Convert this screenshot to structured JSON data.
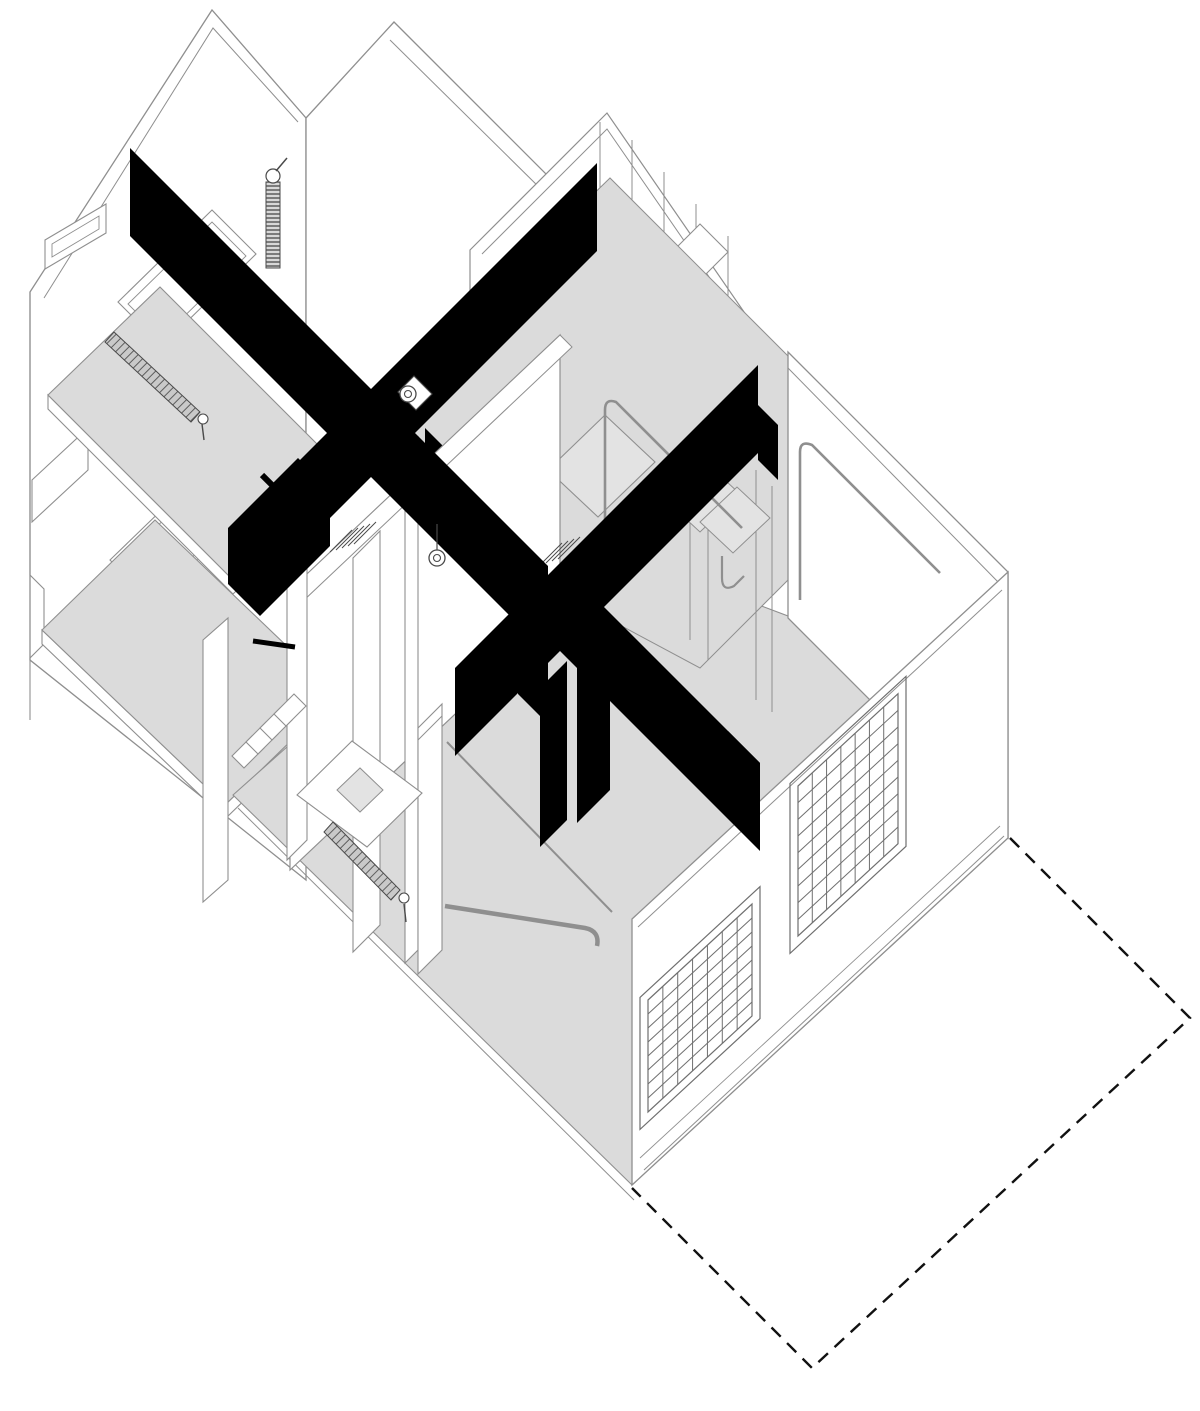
{
  "meta": {
    "title": "Axonometric cutaway drawing of an apartment with X cross-bracing beams",
    "drawing_type": "plan-oblique (military) axonometric, 45 degrees",
    "canvas_w": 1200,
    "canvas_h": 1411,
    "background": "#ffffff"
  },
  "palette": {
    "white": "#ffffff",
    "floor_gray": "#dbdbdb",
    "panel_gray": "#e3e3e3",
    "beam_black": "#000000",
    "line": "#8f8f8f",
    "line_dark": "#4a4a4a",
    "grid_line": "#6f6f6f",
    "dash_color": "#111111"
  },
  "dashed_outline": {
    "name": "projected-footprint-dashed-outline",
    "d": "M 1010 838 L 1190 1018 L 812 1368 L 632 1188",
    "dash": "13 9",
    "sw": 2.4
  },
  "windows": [
    {
      "name": "gridded-window-front-left",
      "x0": 648,
      "y0": 1000,
      "len": 104,
      "slope": -0.923,
      "h": 112,
      "nv": 7,
      "nh": 8
    },
    {
      "name": "gridded-window-front-right",
      "x0": 798,
      "y0": 786,
      "len": 100,
      "slope": -0.923,
      "h": 150,
      "nv": 7,
      "nh": 9
    }
  ],
  "shapes": [
    {
      "name": "wall-back-left",
      "type": "polygon",
      "points": "30,292 212,10 306,118 306,880 30,660",
      "fill": "white",
      "stroke": "line",
      "sw": 1.3
    },
    {
      "name": "wall-back-left-thickness-edge",
      "type": "polyline",
      "points": "44,298 213,28 298,122",
      "fill": "none",
      "stroke": "line",
      "sw": 1
    },
    {
      "name": "wall-back-right",
      "type": "polygon",
      "points": "306,118 394,22 866,494 866,850 306,850",
      "fill": "white",
      "stroke": "line",
      "sw": 1.3
    },
    {
      "name": "wall-back-right-thickness-edge",
      "type": "line",
      "x1": 390,
      "y1": 40,
      "x2": 858,
      "y2": 502,
      "stroke": "line",
      "sw": 1
    },
    {
      "name": "left-wall-window-slit-top",
      "type": "polygon",
      "points": "45,240 106,204 106,233 45,269",
      "fill": "white",
      "stroke": "line",
      "sw": 1.1
    },
    {
      "name": "left-wall-window-slit-top-inner",
      "type": "polygon",
      "points": "52,244 99,216 99,229 52,257",
      "fill": "none",
      "stroke": "line",
      "sw": 0.9
    },
    {
      "name": "left-wall-window-mid",
      "type": "polygon",
      "points": "118,302 212,210 256,254 162,346",
      "fill": "white",
      "stroke": "line",
      "sw": 1.1
    },
    {
      "name": "left-wall-window-mid-inner",
      "type": "polygon",
      "points": "128,304 212,222 246,256 162,338",
      "fill": "none",
      "stroke": "line",
      "sw": 0.9
    },
    {
      "name": "left-wall-window-low",
      "type": "polygon",
      "points": "110,560 205,468 248,511 153,603",
      "fill": "white",
      "stroke": "line",
      "sw": 1.1
    },
    {
      "name": "left-wall-window-low-inner",
      "type": "polygon",
      "points": "120,562 205,480 238,513 153,595",
      "fill": "none",
      "stroke": "line",
      "sw": 0.9
    },
    {
      "name": "left-wall-window-small",
      "type": "polygon",
      "points": "32,480 88,428 88,470 32,522",
      "fill": "white",
      "stroke": "line",
      "sw": 1.1
    },
    {
      "name": "left-wall-profile-steps",
      "type": "path",
      "d": "M 30 292 V 575 l 14 14 v 55 l -14 14 V 720",
      "fill": "none",
      "stroke": "line",
      "sw": 1.1
    },
    {
      "name": "gable-wall-small",
      "type": "polygon",
      "points": "470,250 607,113 753,325 753,460 470,460",
      "fill": "white",
      "stroke": "line",
      "sw": 1.2
    },
    {
      "name": "gable-wall-small-thickness-edge",
      "type": "polyline",
      "points": "482,254 607,129 745,329",
      "fill": "none",
      "stroke": "line",
      "sw": 1
    },
    {
      "name": "wall-fin-1",
      "type": "line",
      "x1": 600,
      "y1": 122,
      "x2": 600,
      "y2": 460,
      "stroke": "line",
      "sw": 1
    },
    {
      "name": "wall-fin-2",
      "type": "line",
      "x1": 632,
      "y1": 140,
      "x2": 632,
      "y2": 460,
      "stroke": "line",
      "sw": 1
    },
    {
      "name": "wall-fin-3",
      "type": "line",
      "x1": 664,
      "y1": 172,
      "x2": 664,
      "y2": 460,
      "stroke": "line",
      "sw": 1
    },
    {
      "name": "wall-fin-4",
      "type": "line",
      "x1": 696,
      "y1": 204,
      "x2": 696,
      "y2": 460,
      "stroke": "line",
      "sw": 1
    },
    {
      "name": "wall-fin-5",
      "type": "line",
      "x1": 728,
      "y1": 236,
      "x2": 728,
      "y2": 460,
      "stroke": "line",
      "sw": 1
    },
    {
      "name": "beam-pocket-tab",
      "type": "polygon",
      "points": "672,252 700,224 728,252 700,280",
      "fill": "white",
      "stroke": "line",
      "sw": 1.1
    },
    {
      "name": "heating-pipe-coil",
      "type": "polygon",
      "points": "266,182 280,182 280,268 266,268",
      "fill": "coil",
      "stroke": "line_dark",
      "sw": 1
    },
    {
      "name": "heating-pipe-valve",
      "type": "circle",
      "cx": 273,
      "cy": 176,
      "r": 7,
      "fill": "white",
      "stroke": "line_dark",
      "sw": 1.2
    },
    {
      "name": "heating-pipe-stem",
      "type": "line",
      "x1": 276,
      "y1": 171,
      "x2": 287,
      "y2": 158,
      "stroke": "line_dark",
      "sw": 1.5
    },
    {
      "name": "floor-upper-slab-edge",
      "type": "polygon",
      "points": "48,395 233,580 345,472 345,486 233,594 48,409",
      "fill": "white",
      "stroke": "line",
      "sw": 1.1
    },
    {
      "name": "floor-upper",
      "type": "polygon",
      "points": "48,395 160,287 345,472 233,580",
      "fill": "floor_gray",
      "stroke": "line",
      "sw": 1.1
    },
    {
      "name": "radiator-upper",
      "type": "polygon",
      "points": "114,332 200,412 191,422 105,342",
      "fill": "hatch",
      "stroke": "line_dark",
      "sw": 1
    },
    {
      "name": "radiator-upper-cap",
      "type": "circle",
      "cx": 203,
      "cy": 419,
      "r": 5,
      "fill": "white",
      "stroke": "line_dark",
      "sw": 1.1
    },
    {
      "name": "radiator-upper-leg",
      "type": "line",
      "x1": 202,
      "y1": 424,
      "x2": 204,
      "y2": 440,
      "stroke": "line_dark",
      "sw": 1.4
    },
    {
      "name": "floor-mid-slab-edge",
      "type": "polygon",
      "points": "42,630 225,805 338,695 338,709 225,819 42,644",
      "fill": "white",
      "stroke": "line",
      "sw": 1.1
    },
    {
      "name": "floor-mid",
      "type": "polygon",
      "points": "42,630 155,520 338,695 225,805",
      "fill": "floor_gray",
      "stroke": "line",
      "sw": 1.1
    },
    {
      "name": "floor-main",
      "type": "polygon",
      "points": "233,795 480,575 640,560 788,616 1008,838 632,1185",
      "fill": "floor_gray",
      "stroke": "line",
      "sw": 1.1
    },
    {
      "name": "floor-main-slab-edge",
      "type": "line",
      "x1": 238,
      "y1": 808,
      "x2": 634,
      "y2": 1200,
      "stroke": "line",
      "sw": 1
    },
    {
      "name": "floor-mezzanine",
      "type": "polygon",
      "points": "388,394 610,178 868,436 868,500 700,668 420,518",
      "fill": "floor_gray",
      "stroke": "line",
      "sw": 1
    },
    {
      "name": "wall-right-room-ne",
      "type": "polygon",
      "points": "788,352 1008,572 1008,838 788,618",
      "fill": "white",
      "stroke": "line",
      "sw": 1.3
    },
    {
      "name": "wall-right-room-ne-parapet",
      "type": "line",
      "x1": 788,
      "y1": 368,
      "x2": 1002,
      "y2": 586,
      "stroke": "line",
      "sw": 1
    },
    {
      "name": "wall-right-room-se",
      "type": "polygon",
      "points": "1008,572 632,919 632,1185 1008,838",
      "fill": "white",
      "stroke": "line",
      "sw": 1.3
    },
    {
      "name": "wall-right-room-se-parapet",
      "type": "line",
      "x1": 1002,
      "y1": 590,
      "x2": 638,
      "y2": 927,
      "stroke": "line",
      "sw": 1
    },
    {
      "name": "wall-right-room-baseboard-1",
      "type": "line",
      "x1": 644,
      "y1": 1170,
      "x2": 1004,
      "y2": 836,
      "stroke": "line",
      "sw": 1
    },
    {
      "name": "wall-right-room-baseboard-2",
      "type": "line",
      "x1": 640,
      "y1": 1158,
      "x2": 1000,
      "y2": 826,
      "stroke": "line",
      "sw": 0.9
    },
    {
      "name": "interior-panel-line-1",
      "type": "line",
      "x1": 690,
      "y1": 440,
      "x2": 690,
      "y2": 640,
      "stroke": "line",
      "sw": 1
    },
    {
      "name": "interior-panel-line-2",
      "type": "line",
      "x1": 708,
      "y1": 452,
      "x2": 708,
      "y2": 660,
      "stroke": "line",
      "sw": 1
    },
    {
      "name": "interior-panel-line-3",
      "type": "line",
      "x1": 756,
      "y1": 470,
      "x2": 756,
      "y2": 700,
      "stroke": "line",
      "sw": 1
    },
    {
      "name": "interior-panel-line-4",
      "type": "line",
      "x1": 772,
      "y1": 486,
      "x2": 772,
      "y2": 712,
      "stroke": "line",
      "sw": 1
    },
    {
      "name": "desk-top",
      "type": "polygon",
      "points": "548,470 605,415 655,462 598,517",
      "fill": "panel_gray",
      "stroke": "line",
      "sw": 1.1
    },
    {
      "name": "shelf-panel-1",
      "type": "polygon",
      "points": "660,495 700,457 740,494 700,532",
      "fill": "panel_gray",
      "stroke": "line",
      "sw": 1
    },
    {
      "name": "shelf-panel-2",
      "type": "polygon",
      "points": "700,522 737,487 770,518 733,553",
      "fill": "panel_gray",
      "stroke": "line",
      "sw": 1
    },
    {
      "name": "handrail-frame-1",
      "type": "path",
      "d": "M 605 578 L 605 410 Q 605 398 616 402 L 742 528",
      "fill": "none",
      "stroke": "line",
      "sw": 2.6
    },
    {
      "name": "handrail-frame-2",
      "type": "path",
      "d": "M 800 600 L 800 452 Q 800 440 812 445 L 940 573",
      "fill": "none",
      "stroke": "line",
      "sw": 2.6
    },
    {
      "name": "handrail-hook",
      "type": "path",
      "d": "M 722 556 L 722 578 Q 722 592 734 586 L 744 576",
      "fill": "none",
      "stroke": "line",
      "sw": 2.2
    },
    {
      "name": "floor-pipe-stub-cap",
      "type": "circle",
      "cx": 431,
      "cy": 737,
      "r": 6,
      "fill": "white",
      "stroke": "line",
      "sw": 1.2
    },
    {
      "name": "floor-pipe-stub",
      "type": "line",
      "x1": 431,
      "y1": 743,
      "x2": 431,
      "y2": 792,
      "stroke": "line",
      "sw": 2.2
    },
    {
      "name": "beam-x2-nwse",
      "type": "polygon",
      "points": "425,428 760,763 760,851 425,516",
      "fill": "beam_black",
      "stroke": "none",
      "sw": 0
    },
    {
      "name": "beam-x2-nwse-end-drop",
      "type": "polygon",
      "points": "728,731 760,763 760,845 728,813",
      "fill": "beam_black",
      "stroke": "none",
      "sw": 0
    },
    {
      "name": "partition-wall-face",
      "type": "polygon",
      "points": "290,590 560,335 560,615 290,870",
      "fill": "white",
      "stroke": "line",
      "sw": 1.2
    },
    {
      "name": "partition-wall-top-edge",
      "type": "polygon",
      "points": "290,590 560,335 572,347 302,602",
      "fill": "white",
      "stroke": "line",
      "sw": 1
    },
    {
      "name": "partition-vent-1a",
      "type": "line",
      "x1": 330,
      "y1": 552,
      "x2": 352,
      "y2": 530,
      "stroke": "line_dark",
      "sw": 1
    },
    {
      "name": "partition-vent-1b",
      "type": "line",
      "x1": 336,
      "y1": 550,
      "x2": 358,
      "y2": 528,
      "stroke": "line_dark",
      "sw": 1
    },
    {
      "name": "partition-vent-1c",
      "type": "line",
      "x1": 342,
      "y1": 548,
      "x2": 364,
      "y2": 526,
      "stroke": "line_dark",
      "sw": 1
    },
    {
      "name": "partition-vent-1d",
      "type": "line",
      "x1": 348,
      "y1": 546,
      "x2": 370,
      "y2": 524,
      "stroke": "line_dark",
      "sw": 1
    },
    {
      "name": "partition-vent-1e",
      "type": "line",
      "x1": 354,
      "y1": 544,
      "x2": 376,
      "y2": 522,
      "stroke": "line_dark",
      "sw": 1
    },
    {
      "name": "partition-vent-2a",
      "type": "line",
      "x1": 540,
      "y1": 565,
      "x2": 562,
      "y2": 543,
      "stroke": "line_dark",
      "sw": 1
    },
    {
      "name": "partition-vent-2b",
      "type": "line",
      "x1": 546,
      "y1": 563,
      "x2": 568,
      "y2": 541,
      "stroke": "line_dark",
      "sw": 1
    },
    {
      "name": "partition-vent-2c",
      "type": "line",
      "x1": 552,
      "y1": 561,
      "x2": 574,
      "y2": 539,
      "stroke": "line_dark",
      "sw": 1
    },
    {
      "name": "partition-vent-2d",
      "type": "line",
      "x1": 558,
      "y1": 559,
      "x2": 580,
      "y2": 537,
      "stroke": "line_dark",
      "sw": 1
    },
    {
      "name": "door-jamb-post",
      "type": "polygon",
      "points": "203,640 228,618 228,880 203,902",
      "fill": "white",
      "stroke": "line",
      "sw": 1.1
    },
    {
      "name": "column-1",
      "type": "polygon",
      "points": "287,560 307,540 307,840 287,860",
      "fill": "white",
      "stroke": "line",
      "sw": 1.1
    },
    {
      "name": "column-2",
      "type": "polygon",
      "points": "353,558 380,531 380,925 353,952",
      "fill": "white",
      "stroke": "line",
      "sw": 1.1
    },
    {
      "name": "column-3-back",
      "type": "polygon",
      "points": "405,450 418,437 418,950 405,963",
      "fill": "white",
      "stroke": "line",
      "sw": 1.1
    },
    {
      "name": "column-3-front",
      "type": "polygon",
      "points": "418,728 442,704 442,950 418,974",
      "fill": "white",
      "stroke": "line",
      "sw": 1.1
    },
    {
      "name": "column-3-seam",
      "type": "line",
      "x1": 418,
      "y1": 740,
      "x2": 442,
      "y2": 716,
      "stroke": "line",
      "sw": 1
    },
    {
      "name": "stair-step-1",
      "type": "polygon",
      "points": "232,756 252,736 264,748 244,768",
      "fill": "white",
      "stroke": "line",
      "sw": 1.1
    },
    {
      "name": "stair-step-2",
      "type": "polygon",
      "points": "246,742 266,722 278,734 258,754",
      "fill": "white",
      "stroke": "line",
      "sw": 1.1
    },
    {
      "name": "stair-step-3",
      "type": "polygon",
      "points": "260,728 280,708 292,720 272,740",
      "fill": "white",
      "stroke": "line",
      "sw": 1.1
    },
    {
      "name": "stair-step-4",
      "type": "polygon",
      "points": "274,714 294,694 306,706 286,726",
      "fill": "white",
      "stroke": "line",
      "sw": 1.1
    },
    {
      "name": "table-top",
      "type": "polygon",
      "points": "297,795 352,741 422,793 367,847",
      "fill": "white",
      "stroke": "line",
      "sw": 1.1
    },
    {
      "name": "table-sink-hole",
      "type": "polygon",
      "points": "337,790 360,768 383,790 360,812",
      "fill": "panel_gray",
      "stroke": "line",
      "sw": 1
    },
    {
      "name": "radiator-lower",
      "type": "polygon",
      "points": "333,822 400,890 391,900 324,832",
      "fill": "hatch",
      "stroke": "line_dark",
      "sw": 1
    },
    {
      "name": "radiator-lower-cap",
      "type": "circle",
      "cx": 404,
      "cy": 898,
      "r": 5,
      "fill": "white",
      "stroke": "line_dark",
      "sw": 1.1
    },
    {
      "name": "radiator-lower-leg",
      "type": "line",
      "x1": 404,
      "y1": 904,
      "x2": 406,
      "y2": 922,
      "stroke": "line_dark",
      "sw": 1.4
    },
    {
      "name": "drain-pipe",
      "type": "path",
      "d": "M 445 906 L 585 928 Q 600 931 597 946",
      "fill": "none",
      "stroke": "line",
      "sw": 4.5
    },
    {
      "name": "stair-rail-stringer",
      "type": "line",
      "x1": 447,
      "y1": 742,
      "x2": 612,
      "y2": 912,
      "stroke": "line",
      "sw": 2
    },
    {
      "name": "beam-x1-nwse",
      "type": "polygon",
      "points": "130,148 548,566 548,654 130,236",
      "fill": "beam_black",
      "stroke": "none",
      "sw": 0
    },
    {
      "name": "beam-x1-nwse-end-drop",
      "type": "polygon",
      "points": "518,624 548,654 548,724 518,694",
      "fill": "beam_black",
      "stroke": "none",
      "sw": 0
    },
    {
      "name": "beam-x1-nesw",
      "type": "polygon",
      "points": "597,163 597,251 262,586 262,498",
      "fill": "beam_black",
      "stroke": "none",
      "sw": 0
    },
    {
      "name": "beam-x1-nesw-end-block",
      "type": "polygon",
      "points": "228,528 298,458 330,490 330,546 260,616 228,584",
      "fill": "beam_black",
      "stroke": "none",
      "sw": 0
    },
    {
      "name": "black-strut-1",
      "type": "line",
      "x1": 262,
      "y1": 475,
      "x2": 298,
      "y2": 511,
      "stroke": "beam_black",
      "sw": 6
    },
    {
      "name": "black-strut-2",
      "type": "line",
      "x1": 253,
      "y1": 641,
      "x2": 295,
      "y2": 647,
      "stroke": "beam_black",
      "sw": 5
    },
    {
      "name": "beam-x2-nesw",
      "type": "polygon",
      "points": "758,365 758,453 455,756 455,668",
      "fill": "beam_black",
      "stroke": "none",
      "sw": 0
    },
    {
      "name": "beam-x2-nesw-ne-drop",
      "type": "polygon",
      "points": "758,405 778,425 778,480 758,460",
      "fill": "beam_black",
      "stroke": "none",
      "sw": 0
    },
    {
      "name": "beam-x2-hanger-bar-1",
      "type": "polygon",
      "points": "540,688 567,661 567,820 540,847",
      "fill": "beam_black",
      "stroke": "none",
      "sw": 0
    },
    {
      "name": "beam-x2-hanger-bar-2",
      "type": "polygon",
      "points": "577,651 610,618 610,790 577,823",
      "fill": "beam_black",
      "stroke": "none",
      "sw": 0
    },
    {
      "name": "pendant-lamp-1-bracket",
      "type": "polygon",
      "points": "398,392 414,376 432,394 416,410",
      "fill": "white",
      "stroke": "line_dark",
      "sw": 1.1
    },
    {
      "name": "pendant-lamp-1",
      "type": "circle",
      "cx": 408,
      "cy": 394,
      "r": 8,
      "fill": "white",
      "stroke": "line_dark",
      "sw": 1.3
    },
    {
      "name": "pendant-lamp-1-bulb",
      "type": "circle",
      "cx": 408,
      "cy": 394,
      "r": 3.5,
      "fill": "white",
      "stroke": "line_dark",
      "sw": 1.1
    },
    {
      "name": "pendant-lamp-2-cord",
      "type": "line",
      "x1": 437,
      "y1": 524,
      "x2": 437,
      "y2": 551,
      "stroke": "line_dark",
      "sw": 1.2
    },
    {
      "name": "pendant-lamp-2",
      "type": "circle",
      "cx": 437,
      "cy": 558,
      "r": 8,
      "fill": "white",
      "stroke": "line_dark",
      "sw": 1.3
    },
    {
      "name": "pendant-lamp-2-bulb",
      "type": "circle",
      "cx": 437,
      "cy": 558,
      "r": 3.5,
      "fill": "white",
      "stroke": "line_dark",
      "sw": 1.1
    }
  ]
}
